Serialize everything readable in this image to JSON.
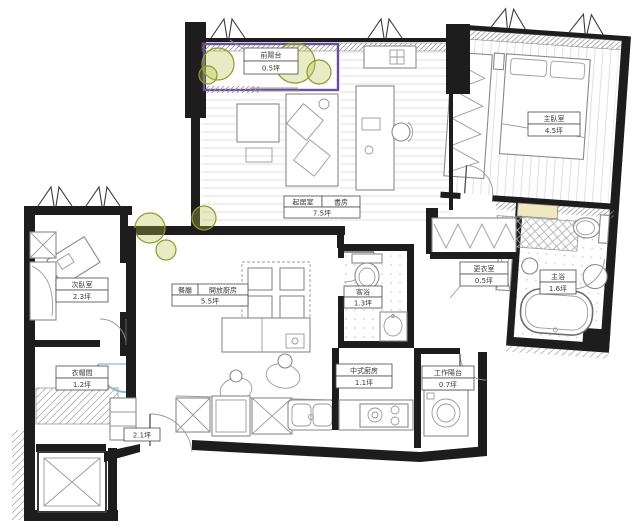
{
  "meta": {
    "type": "apartment-floor-plan",
    "language": "zh-TW",
    "area_unit": "坪"
  },
  "colors": {
    "wall": "#1d1d1d",
    "linework": "#8a8a8a",
    "floor_line": "#e2e2e2",
    "tree_fill": "#b9c14d",
    "tree_stroke": "#8f9a2e",
    "balcony_outline": "#6a4f9d",
    "counter_yellow": "#efe9c0",
    "door_arc_blue": "#8fb8d8",
    "label_text": "#3a3a3a"
  },
  "rooms": {
    "front_balcony": {
      "name": "前陽台",
      "area": "0.5坪"
    },
    "living_study": {
      "name_left": "起居室",
      "name_right": "書房",
      "area": "7.5坪"
    },
    "master_bedroom": {
      "name": "主臥室",
      "area": "4.5坪"
    },
    "second_bedroom": {
      "name": "次臥室",
      "area": "2.3坪"
    },
    "dining_open_kitchen": {
      "name_left": "餐廳",
      "name_right": "開放廚房",
      "area": "5.5坪"
    },
    "guest_bath": {
      "name": "客浴",
      "area": "1.3坪"
    },
    "walk_in_closet": {
      "name": "更衣室",
      "area": "0.5坪"
    },
    "master_bath": {
      "name": "主浴",
      "area": "1.6坪"
    },
    "chinese_kitchen": {
      "name": "中式廚房",
      "area": "1.1坪"
    },
    "work_balcony": {
      "name": "工作陽台",
      "area": "0.7坪"
    },
    "cloakroom": {
      "name": "衣帽間",
      "area": "1.2坪"
    },
    "foyer": {
      "area": "2.1坪"
    }
  }
}
